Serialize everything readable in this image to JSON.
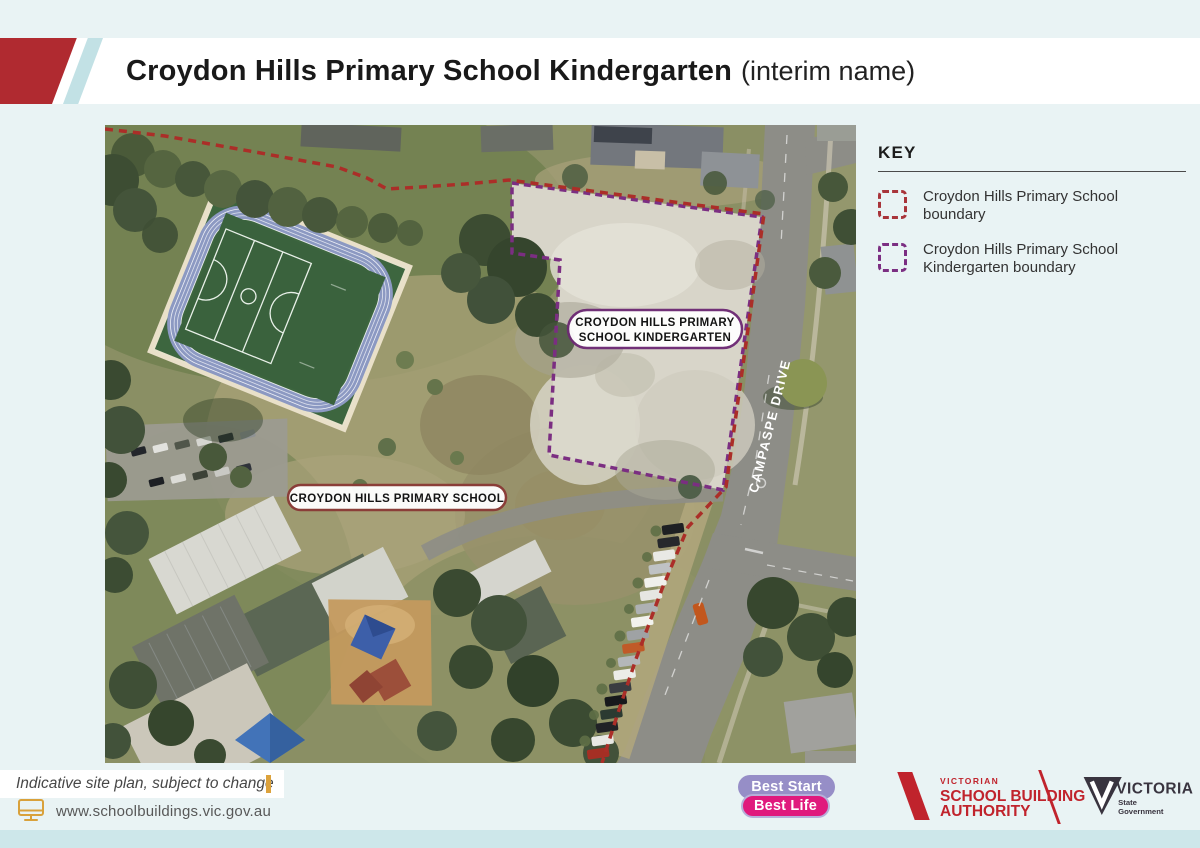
{
  "header": {
    "title": "Croydon Hills Primary School Kindergarten",
    "title_suffix": "(interim name)",
    "accent_red": "#b02a30",
    "accent_blue": "#c2e1e5"
  },
  "key": {
    "heading": "KEY",
    "items": [
      {
        "line1": "Croydon Hills Primary School",
        "line2": "boundary",
        "color": "#a8343a"
      },
      {
        "line1": "Croydon Hills Primary School",
        "line2": "Kindergarten boundary",
        "color": "#7b2e82"
      }
    ]
  },
  "map": {
    "labels": {
      "kindergarten_line1": "CROYDON HILLS PRIMARY",
      "kindergarten_line2": "SCHOOL KINDERGARTEN",
      "school": "CROYDON HILLS PRIMARY SCHOOL",
      "road": "CAMPASPE DRIVE"
    },
    "boundary_colors": {
      "school": "#ab2e28",
      "kindergarten": "#7b2e82"
    }
  },
  "footer": {
    "note": "Indicative site plan, subject to change",
    "url": "www.schoolbuildings.vic.gov.au",
    "best_start_line1": "Best Start",
    "best_start_line2": "Best Life",
    "vsba": {
      "small": "VICTORIAN",
      "line1": "SCHOOL BUILDING",
      "line2": "AUTHORITY",
      "color": "#c0232c"
    },
    "victoria": {
      "word": "VICTORIA",
      "sub1": "State",
      "sub2": "Government",
      "color": "#39343f"
    }
  }
}
